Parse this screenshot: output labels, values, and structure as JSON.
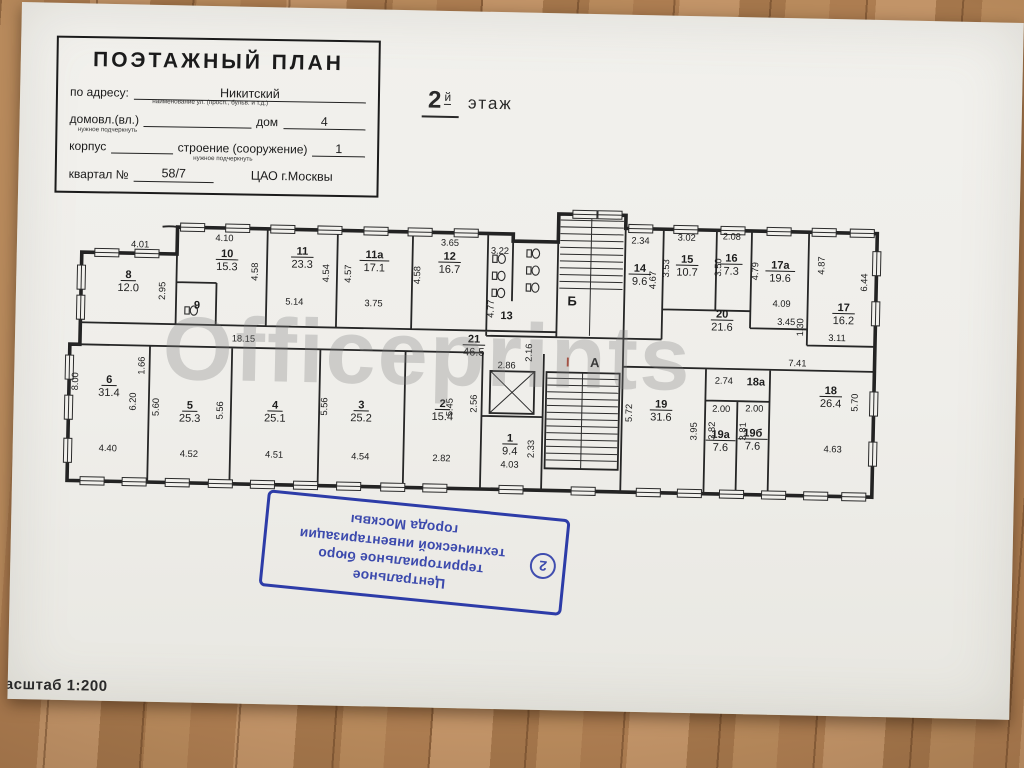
{
  "title_block": {
    "title": "ПОЭТАЖНЫЙ ПЛАН",
    "address_label": "по адресу:",
    "address_value": "Никитский",
    "address_hint": "наименование ул. (просп., бульв. и т.д.)",
    "ownership_label": "домовл.(вл.)",
    "ownership_hint": "нужное подчеркнуть",
    "house_label": "дом",
    "house_value": "4",
    "building_label": "корпус",
    "structure_label": "строение (сооружение)",
    "structure_hint": "нужное подчеркнуть",
    "structure_value": "1",
    "quarter_label": "квартал №",
    "quarter_value": "58/7",
    "district": "ЦАО г.Москвы"
  },
  "floor_heading": {
    "number": "2",
    "suffix": "й",
    "word": "этаж"
  },
  "watermark": "Officeprints",
  "scale_label": "Масштаб 1:200",
  "stamp": {
    "number": "2",
    "lines": [
      "Центральное",
      "территориальное бюро",
      "технической инвентаризации",
      "города Москвы"
    ],
    "color": "#2d3ca8"
  },
  "plan": {
    "rooms": [
      {
        "num": "8",
        "area": "12.0",
        "x": 62,
        "y": 85
      },
      {
        "num": "9",
        "area": null,
        "x": 131,
        "y": 114
      },
      {
        "num": "10",
        "area": "15.3",
        "x": 160,
        "y": 62
      },
      {
        "num": "11",
        "area": "23.3",
        "x": 235,
        "y": 58
      },
      {
        "num": "11а",
        "area": "17.1",
        "x": 307,
        "y": 60
      },
      {
        "num": "12",
        "area": "16.7",
        "x": 382,
        "y": 60
      },
      {
        "num": "13",
        "area": null,
        "x": 440,
        "y": 118
      },
      {
        "num": "14",
        "area": "9.6",
        "x": 572,
        "y": 68
      },
      {
        "num": "15",
        "area": "10.7",
        "x": 619,
        "y": 58
      },
      {
        "num": "16",
        "area": "7.3",
        "x": 663,
        "y": 56
      },
      {
        "num": "17а",
        "area": "19.6",
        "x": 712,
        "y": 62
      },
      {
        "num": "17",
        "area": "16.2",
        "x": 776,
        "y": 103
      },
      {
        "num": "20",
        "area": "21.6",
        "x": 655,
        "y": 112
      },
      {
        "num": "21",
        "area": "46.5",
        "x": 408,
        "y": 142
      },
      {
        "num": "6",
        "area": "31.4",
        "x": 45,
        "y": 190
      },
      {
        "num": "5",
        "area": "25.3",
        "x": 126,
        "y": 214
      },
      {
        "num": "4",
        "area": "25.1",
        "x": 211,
        "y": 212
      },
      {
        "num": "3",
        "area": "25.2",
        "x": 297,
        "y": 210
      },
      {
        "num": "2",
        "area": "15.4",
        "x": 378,
        "y": 207
      },
      {
        "num": "1",
        "area": "9.4",
        "x": 446,
        "y": 240
      },
      {
        "num": "19",
        "area": "31.6",
        "x": 596,
        "y": 203
      },
      {
        "num": "19а",
        "area": "7.6",
        "x": 656,
        "y": 232
      },
      {
        "num": "19б",
        "area": "7.6",
        "x": 688,
        "y": 230
      },
      {
        "num": "18а",
        "area": null,
        "x": 690,
        "y": 179
      },
      {
        "num": "18",
        "area": "26.4",
        "x": 765,
        "y": 186
      }
    ],
    "dims": [
      {
        "t": "4.01",
        "x": 73,
        "y": 54,
        "r": 0
      },
      {
        "t": "2.95",
        "x": 99,
        "y": 97,
        "r": 1
      },
      {
        "t": "4.10",
        "x": 157,
        "y": 46,
        "r": 0
      },
      {
        "t": "4.58",
        "x": 191,
        "y": 76,
        "r": 1
      },
      {
        "t": "5.14",
        "x": 228,
        "y": 108,
        "r": 0
      },
      {
        "t": "4.54",
        "x": 262,
        "y": 76,
        "r": 1
      },
      {
        "t": "4.57",
        "x": 284,
        "y": 76,
        "r": 1
      },
      {
        "t": "3.75",
        "x": 307,
        "y": 108,
        "r": 0
      },
      {
        "t": "3.65",
        "x": 382,
        "y": 46,
        "r": 0
      },
      {
        "t": "4.58",
        "x": 353,
        "y": 76,
        "r": 1
      },
      {
        "t": "3.22",
        "x": 432,
        "y": 53,
        "r": 0
      },
      {
        "t": "4.77",
        "x": 427,
        "y": 108,
        "r": 1
      },
      {
        "t": "2.34",
        "x": 572,
        "y": 40,
        "r": 0
      },
      {
        "t": "4.67",
        "x": 588,
        "y": 76,
        "r": 1
      },
      {
        "t": "3.02",
        "x": 618,
        "y": 36,
        "r": 0
      },
      {
        "t": "3.53",
        "x": 601,
        "y": 64,
        "r": 1
      },
      {
        "t": "2.08",
        "x": 663,
        "y": 34,
        "r": 0
      },
      {
        "t": "3.50",
        "x": 653,
        "y": 62,
        "r": 1
      },
      {
        "t": "4.79",
        "x": 690,
        "y": 65,
        "r": 1
      },
      {
        "t": "4.87",
        "x": 756,
        "y": 58,
        "r": 1
      },
      {
        "t": "4.09",
        "x": 714,
        "y": 100,
        "r": 0
      },
      {
        "t": "6.44",
        "x": 799,
        "y": 74,
        "r": 1
      },
      {
        "t": "3.45",
        "x": 719,
        "y": 118,
        "r": 0
      },
      {
        "t": "1.30",
        "x": 736,
        "y": 120,
        "r": 1
      },
      {
        "t": "3.11",
        "x": 770,
        "y": 133,
        "r": 0
      },
      {
        "t": "2.16",
        "x": 466,
        "y": 151,
        "r": 1
      },
      {
        "t": "18.15",
        "x": 178,
        "y": 146,
        "r": 0
      },
      {
        "t": "2.86",
        "x": 441,
        "y": 167,
        "r": 0
      },
      {
        "t": "2.56",
        "x": 412,
        "y": 203,
        "r": 1
      },
      {
        "t": "7.41",
        "x": 731,
        "y": 159,
        "r": 0
      },
      {
        "t": "2.74",
        "x": 658,
        "y": 178,
        "r": 0
      },
      {
        "t": "8.00",
        "x": 14,
        "y": 189,
        "r": 1
      },
      {
        "t": "1.66",
        "x": 80,
        "y": 172,
        "r": 1
      },
      {
        "t": "6.20",
        "x": 72,
        "y": 208,
        "r": 1
      },
      {
        "t": "5.60",
        "x": 95,
        "y": 213,
        "r": 1
      },
      {
        "t": "4.40",
        "x": 45,
        "y": 258,
        "r": 0
      },
      {
        "t": "4.52",
        "x": 126,
        "y": 262,
        "r": 0
      },
      {
        "t": "5.56",
        "x": 159,
        "y": 215,
        "r": 1
      },
      {
        "t": "4.51",
        "x": 211,
        "y": 261,
        "r": 0
      },
      {
        "t": "5.56",
        "x": 263,
        "y": 209,
        "r": 1
      },
      {
        "t": "4.54",
        "x": 297,
        "y": 261,
        "r": 0
      },
      {
        "t": "5.45",
        "x": 388,
        "y": 207,
        "r": 1
      },
      {
        "t": "2.82",
        "x": 378,
        "y": 261,
        "r": 0
      },
      {
        "t": "4.03",
        "x": 446,
        "y": 266,
        "r": 0
      },
      {
        "t": "2.33",
        "x": 470,
        "y": 247,
        "r": 1
      },
      {
        "t": "5.72",
        "x": 567,
        "y": 209,
        "r": 1
      },
      {
        "t": "3.95",
        "x": 632,
        "y": 226,
        "r": 1
      },
      {
        "t": "3.82",
        "x": 650,
        "y": 225,
        "r": 1
      },
      {
        "t": "3.81",
        "x": 681,
        "y": 225,
        "r": 1
      },
      {
        "t": "2.00",
        "x": 656,
        "y": 206,
        "r": 0
      },
      {
        "t": "2.00",
        "x": 689,
        "y": 205,
        "r": 0
      },
      {
        "t": "5.70",
        "x": 792,
        "y": 194,
        "r": 1
      },
      {
        "t": "4.63",
        "x": 768,
        "y": 244,
        "r": 0
      }
    ],
    "stairs": [
      {
        "t": "Б",
        "x": 505,
        "y": 103
      },
      {
        "t": "А",
        "x": 529,
        "y": 164
      }
    ],
    "section_mark": {
      "t": "I",
      "x": 502,
      "y": 164
    }
  }
}
